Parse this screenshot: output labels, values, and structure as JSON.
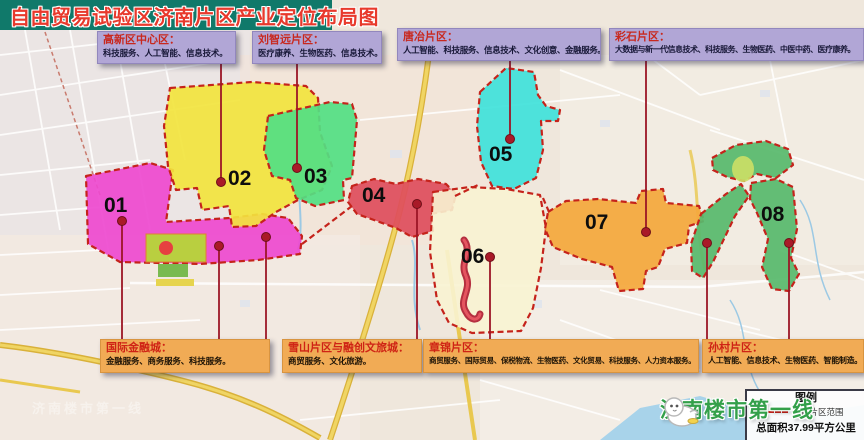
{
  "title": "自由贸易试验区济南片区产业定位布局图",
  "top_callouts": [
    {
      "name": "高新区中心区：",
      "desc": "科技服务、人工智能、信息技术。"
    },
    {
      "name": "刘智远片区：",
      "desc": "医疗康养、生物医药、信息技术。"
    },
    {
      "name": "唐冶片区：",
      "desc": "人工智能、科技服务、信息技术、文化创意、金融服务。"
    },
    {
      "name": "彩石片区：",
      "desc": "大数据与新一代信息技术、科技服务、生物医药、中医中药、医疗康养。"
    }
  ],
  "bottom_callouts": [
    {
      "name": "国际金融城：",
      "desc": "金融服务、商务服务、科技服务。"
    },
    {
      "name": "雪山片区与融创文旅城：",
      "desc": "商贸服务、文化旅游。"
    },
    {
      "name": "章锦片区：",
      "desc": "商贸服务、国际贸易、保税物流、生物医药、文化贸易、科技服务、人力资本服务。"
    },
    {
      "name": "孙村片区：",
      "desc": "人工智能、信息技术、生物医药、智能制造。"
    }
  ],
  "zones": [
    {
      "num": "01"
    },
    {
      "num": "02"
    },
    {
      "num": "03"
    },
    {
      "num": "04"
    },
    {
      "num": "05"
    },
    {
      "num": "06"
    },
    {
      "num": "07"
    },
    {
      "num": "08"
    }
  ],
  "legend": {
    "title": "图例",
    "boundary_label": "济南片区范围",
    "total_area": "总面积37.99平方公里"
  },
  "watermark": {
    "brand": "济南楼市第一线"
  },
  "colors": {
    "banner_bg": "#10796a",
    "banner_text": "#e8392c",
    "zone01": "#ee49cf",
    "zone02": "#f2e43e",
    "zone03": "#52e083",
    "zone04": "#df4f5c",
    "zone05": "#3fe2da",
    "zone06": "#f8f3d2",
    "zone07": "#f4a83c",
    "zone08": "#58b96d",
    "leader_line": "#9c1626",
    "top_box": "#b1a6d6",
    "bottom_box": "#f1ab55",
    "watermark_green": "#33a04a"
  }
}
